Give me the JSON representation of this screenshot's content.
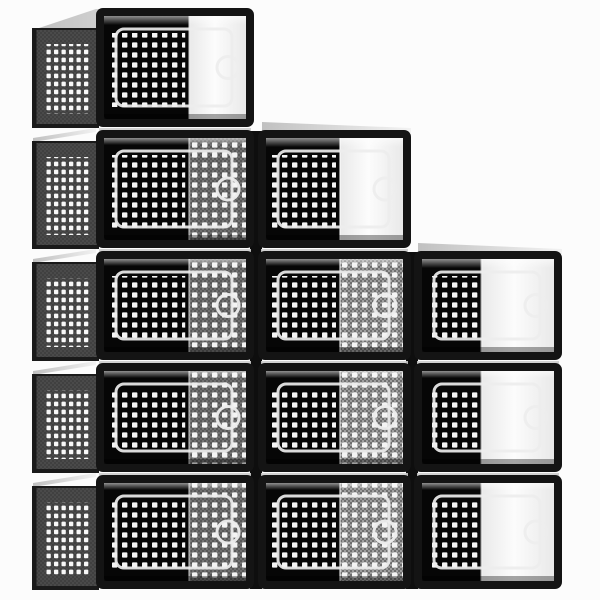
{
  "meta": {
    "type": "product-photo",
    "subject": "12-pack clear stackable shoe storage boxes with black frames, arranged in a descending staircase of three stacks (5, 4 and 3 boxes), viewed from the front-left",
    "box_count": 12
  },
  "canvas": {
    "width": 600,
    "height": 600,
    "background": "#fcfcfc"
  },
  "colors": {
    "frame": "#141414",
    "frame_gap": "#0e0e0e",
    "interior": "#060606",
    "dot": "#f4f4f4",
    "mesh_mid_base": "#9e9e9e",
    "mesh_mid_check": "#6f6f6f",
    "mesh_dark_base": "#707070",
    "mesh_dark_check": "#585858",
    "side_base": "#4a4a4a",
    "side_check": "#404040",
    "side_hole": "#f8f8f8",
    "side_edge": "#1a1a1a",
    "white_shade": "#e9e9e9",
    "white_light": "#fcfcfc",
    "door_outline": "#ededed",
    "lid_light": "#f2f2f2",
    "lid_dark": "#c0c0c0",
    "strip": "#cdcdcd",
    "reflection": "#ffffff"
  },
  "geometry": {
    "rows": [
      {
        "y": 8,
        "h": 119
      },
      {
        "y": 130,
        "h": 118
      },
      {
        "y": 251,
        "h": 109
      },
      {
        "y": 363,
        "h": 109
      },
      {
        "y": 475,
        "h": 114
      }
    ],
    "columns": [
      {
        "id": "right",
        "x": 414,
        "w": 148,
        "first_row": 2,
        "right_fraction": 0.45,
        "has_side_panel": false
      },
      {
        "id": "middle",
        "x": 258,
        "w": 153,
        "first_row": 1,
        "right_fraction": 0.54,
        "has_side_panel": false
      },
      {
        "id": "left",
        "x": 96,
        "w": 158,
        "first_row": 0,
        "right_fraction": 0.6,
        "has_side_panel": true,
        "side": {
          "x": 33,
          "w": 63,
          "top_offset_first": 21,
          "top_offset": 12
        }
      }
    ],
    "frame_inset": 8,
    "door": {
      "inset_left": 12,
      "inset_right": 14,
      "inset_y": 13,
      "corner_radius": 8,
      "handle_radius": 11,
      "stroke_width": 3
    },
    "column_gaps": [
      {
        "x": 250,
        "y": 131,
        "w": 12,
        "h": 458
      },
      {
        "x": 406,
        "y": 252,
        "w": 12,
        "h": 337
      }
    ]
  },
  "boxes": [
    {
      "column": "left",
      "row": 0,
      "right_style": "open-white",
      "door": "open"
    },
    {
      "column": "left",
      "row": 1,
      "right_style": "mesh-dark",
      "door": "closed"
    },
    {
      "column": "left",
      "row": 2,
      "right_style": "mesh-dark",
      "door": "closed"
    },
    {
      "column": "left",
      "row": 3,
      "right_style": "mesh-dark",
      "door": "closed"
    },
    {
      "column": "left",
      "row": 4,
      "right_style": "mesh-dark",
      "door": "closed"
    },
    {
      "column": "middle",
      "row": 1,
      "right_style": "open-white",
      "door": "open"
    },
    {
      "column": "middle",
      "row": 2,
      "right_style": "mesh-mid",
      "door": "closed"
    },
    {
      "column": "middle",
      "row": 3,
      "right_style": "mesh-mid",
      "door": "closed"
    },
    {
      "column": "middle",
      "row": 4,
      "right_style": "mesh-mid",
      "door": "closed"
    },
    {
      "column": "right",
      "row": 2,
      "right_style": "open-white",
      "door": "open"
    },
    {
      "column": "right",
      "row": 3,
      "right_style": "open-white",
      "door": "open"
    },
    {
      "column": "right",
      "row": 4,
      "right_style": "open-white",
      "door": "open"
    }
  ]
}
